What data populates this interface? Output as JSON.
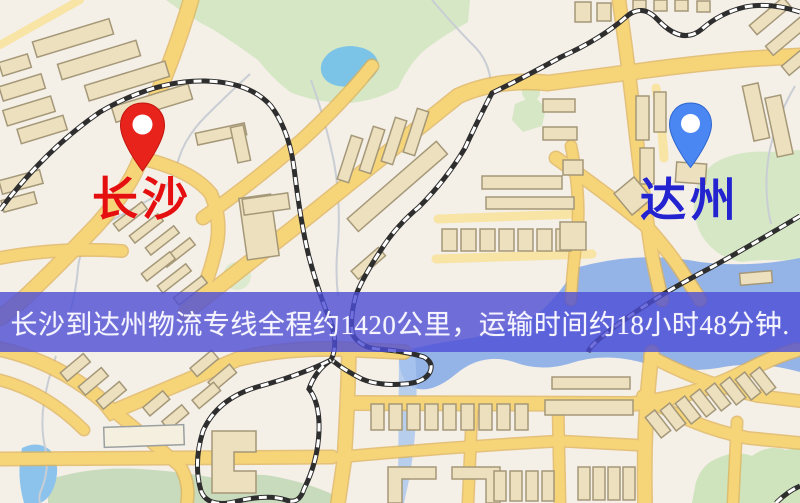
{
  "banner": {
    "text": "长沙到达州物流专线全程约1420公里，运输时间约18小时48分钟.",
    "background_color": "#4d4dd6",
    "text_color": "#f6f5ff"
  },
  "route": {
    "origin_city": "长沙",
    "destination_city": "达州",
    "distance_text": "约1420公里",
    "duration_text": "约18小时48分钟"
  },
  "origin": {
    "name": "长沙",
    "label_color": "#e60f0f",
    "pin_color": "#e8231c"
  },
  "destination": {
    "name": "达州",
    "label_color": "#2323cf",
    "pin_color": "#4a87f2"
  },
  "map_colors": {
    "background": "#f4efe7",
    "road_fill": "#f6d478",
    "road_casing": "#dfb256",
    "minor_road": "#f8e4a4",
    "building": "#ece0bf",
    "building_outline": "#a59878",
    "park": "#d5e7c4",
    "water": "#7cc3e8",
    "water_lagoon": "#8aade8",
    "railway": "#2e2e2e"
  }
}
